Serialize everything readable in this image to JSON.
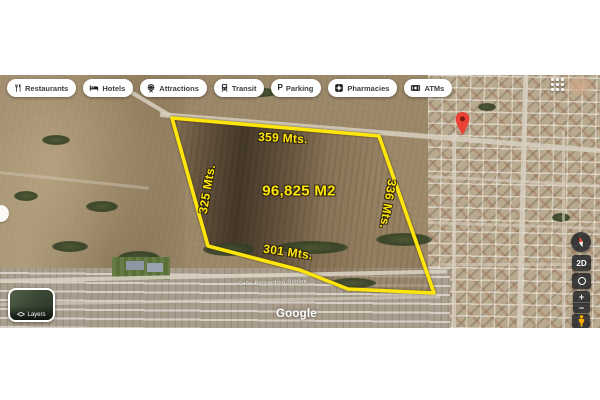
{
  "toolbar": {
    "items": [
      {
        "label": "Restaurants",
        "icon": "restaurants-icon"
      },
      {
        "label": "Hotels",
        "icon": "hotels-icon"
      },
      {
        "label": "Attractions",
        "icon": "attractions-icon"
      },
      {
        "label": "Transit",
        "icon": "transit-icon"
      },
      {
        "label": "Parking",
        "icon": "parking-icon"
      },
      {
        "label": "Pharmacies",
        "icon": "pharmacies-icon"
      },
      {
        "label": "ATMs",
        "icon": "atms-icon"
      }
    ]
  },
  "parcel": {
    "area_label": "96,825 M2",
    "side_top": "359 Mts.",
    "side_left": "325 Mts.",
    "side_right": "336 Mts.",
    "side_bottom": "301 Mts.",
    "outline_color": "#ffe60a"
  },
  "map": {
    "street_label": "Calle Bernardino Robles",
    "attribution": "Google"
  },
  "controls": {
    "view_2d": "2D",
    "zoom_in": "+",
    "zoom_out": "−",
    "layers_label": "Layers"
  },
  "marker": {
    "color": "#ea4335"
  }
}
